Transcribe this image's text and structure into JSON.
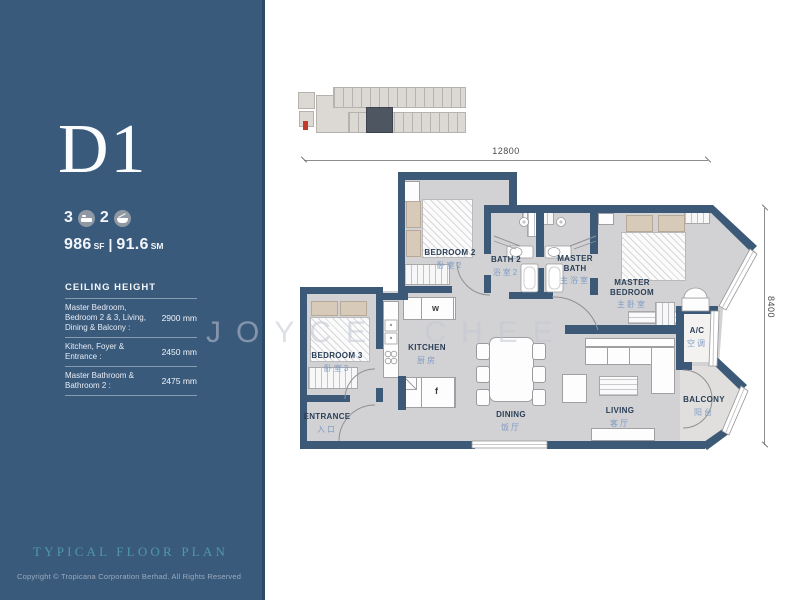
{
  "sidebar": {
    "unit_label": "D1",
    "stats": {
      "bedrooms": "3",
      "bathrooms": "2"
    },
    "area": {
      "sf_value": "986",
      "sf_unit": "SF",
      "separator": "|",
      "sm_value": "91.6",
      "sm_unit": "SM"
    },
    "ceiling": {
      "title": "CEILING HEIGHT",
      "rows": [
        {
          "label": "Master Bedroom, Bedroom 2 & 3, Living, Dining & Balcony :",
          "value": "2900 mm"
        },
        {
          "label": "Kitchen, Foyer & Entrance :",
          "value": "2450 mm"
        },
        {
          "label": "Master Bathroom & Bathroom 2 :",
          "value": "2475 mm"
        }
      ]
    },
    "plan_type": "TYPICAL FLOOR PLAN",
    "copyright": "Copyright © Tropicana Corporation Berhad. All Rights Reserved"
  },
  "plan": {
    "dimension_width_mm": "12800",
    "dimension_height_mm": "8400",
    "watermark": "JOYCE CHEE",
    "appliances": {
      "washer": "w",
      "fridge": "f"
    },
    "rooms": [
      {
        "en": "BEDROOM 2",
        "cn": "卧室2"
      },
      {
        "en": "BATH 2",
        "cn": "浴室2"
      },
      {
        "en": "MASTER BATH",
        "cn": "主浴室"
      },
      {
        "en": "MASTER BEDROOM",
        "cn": "主卧室"
      },
      {
        "en": "A/C",
        "cn": "空调"
      },
      {
        "en": "BEDROOM 3",
        "cn": "卧室3"
      },
      {
        "en": "KITCHEN",
        "cn": "厨房"
      },
      {
        "en": "ENTRANCE",
        "cn": "入口"
      },
      {
        "en": "DINING",
        "cn": "饭厅"
      },
      {
        "en": "LIVING",
        "cn": "客厅"
      },
      {
        "en": "BALCONY",
        "cn": "阳台"
      }
    ]
  },
  "colors": {
    "sidebar_bg": "#3a5a7c",
    "wall": "#3c5a78",
    "floor": "#d2d2d4",
    "accent_teal": "#4e97ac",
    "cn_label": "#7f9cc4",
    "en_label": "#2b3f58",
    "keyplan_highlight": "#4e5661",
    "north_red": "#c23b2a"
  }
}
